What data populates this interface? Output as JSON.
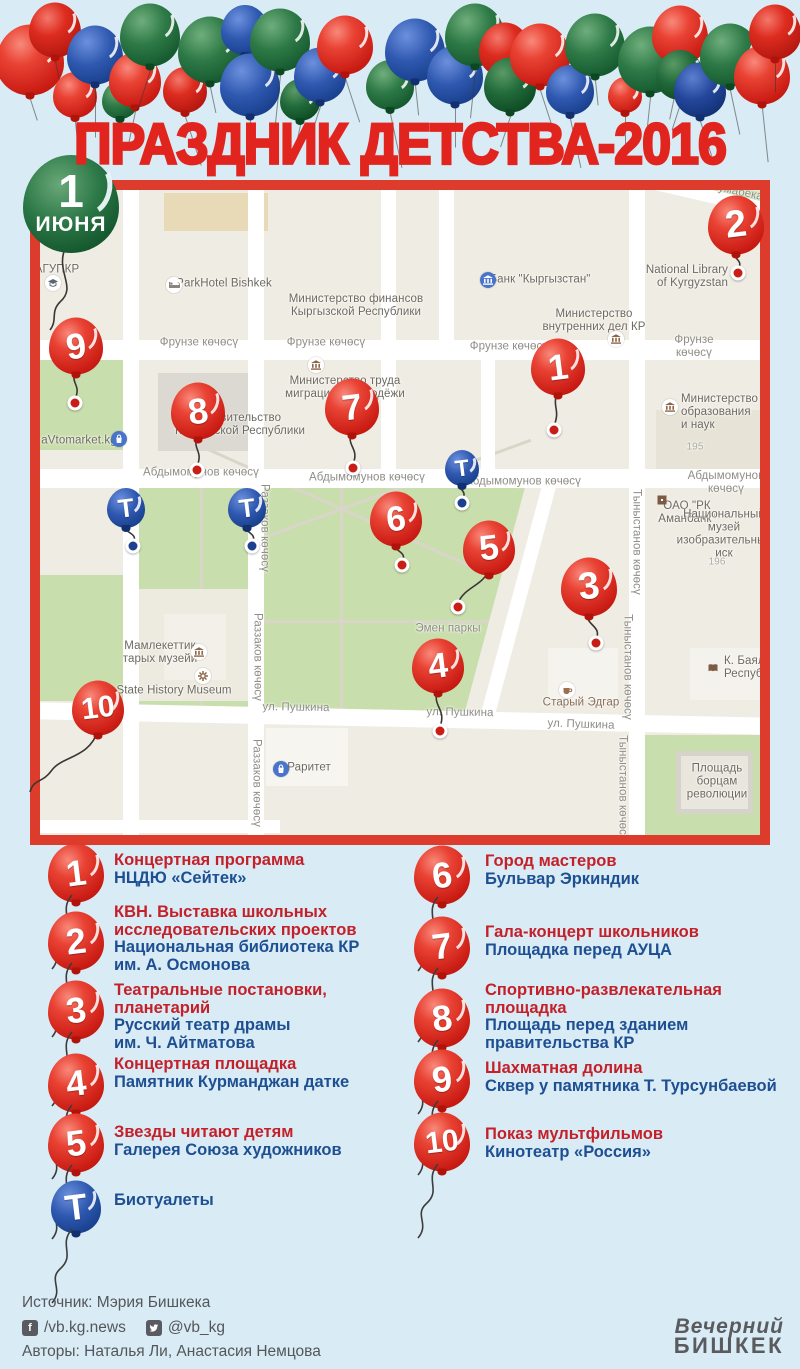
{
  "title": "ПРАЗДНИК ДЕТСТВА-2016",
  "date_badge": {
    "day": "1",
    "month": "ИЮНЯ"
  },
  "map": {
    "street_labels": [
      {
        "t": "Фрунзе көчөсү",
        "x": 159,
        "y": 153
      },
      {
        "t": "Фрунзе көчөсү",
        "x": 286,
        "y": 153
      },
      {
        "t": "Фрунзе көчөсү",
        "x": 469,
        "y": 157
      },
      {
        "t": "Фрунзе көчөсү",
        "x": 654,
        "y": 157
      },
      {
        "t": "Абдымомунов көчөсү",
        "x": 161,
        "y": 283
      },
      {
        "t": "Абдымомунов көчөсү",
        "x": 327,
        "y": 288
      },
      {
        "t": "Абдымомунов көчөсү",
        "x": 483,
        "y": 292
      },
      {
        "t": "Абдымомунов көчөсү",
        "x": 686,
        "y": 293
      },
      {
        "t": "Раззаков көчөсү",
        "x": 224,
        "y": 338,
        "rot": 90
      },
      {
        "t": "Раззаков көчөсү",
        "x": 217,
        "y": 467,
        "rot": 90
      },
      {
        "t": "Раззаков көчөсү",
        "x": 216,
        "y": 593,
        "rot": 90
      },
      {
        "t": "Тыныстанов көчөсү",
        "x": 596,
        "y": 352,
        "rot": 90
      },
      {
        "t": "Тыныстанов көчөсү",
        "x": 587,
        "y": 477,
        "rot": 90
      },
      {
        "t": "Тыныстанов көчөсү",
        "x": 582,
        "y": 598,
        "rot": 90
      },
      {
        "t": "ул. Пушкина",
        "x": 256,
        "y": 518,
        "rot": 1
      },
      {
        "t": "ул. Пушкина",
        "x": 420,
        "y": 523,
        "rot": 1
      },
      {
        "t": "ул. Пушкина",
        "x": 541,
        "y": 535,
        "rot": 2
      },
      {
        "t": "Жумабека к",
        "x": 694,
        "y": 8,
        "rot": 12
      },
      {
        "t": "Эмен паркы",
        "x": 408,
        "y": 439
      }
    ],
    "poi_labels": [
      {
        "t": "АГУПКР",
        "x": 17,
        "y": 80,
        "cls": "poi"
      },
      {
        "t": "ParkHotel Bishkek",
        "x": 184,
        "y": 94,
        "cls": "poi"
      },
      {
        "t": "Министерство финансов\nКыргызской Республики",
        "x": 316,
        "y": 116,
        "cls": "poi"
      },
      {
        "t": "Банк \"Кыргызстан\"",
        "x": 500,
        "y": 90,
        "cls": "poi"
      },
      {
        "t": "Министерство\nвнутренних дел КР",
        "x": 554,
        "y": 131,
        "cls": "poi"
      },
      {
        "t": "National Library\nof Kyrgyzstan",
        "left": 596,
        "top": 74,
        "w": 92,
        "align": "right",
        "cls": "poi"
      },
      {
        "t": "Правительство\nКыргызской Республики",
        "x": 200,
        "y": 235,
        "cls": "poi"
      },
      {
        "t": "Министерство труда\nмиграции и молодёжи",
        "x": 305,
        "y": 198,
        "cls": "poi"
      },
      {
        "t": "Министерство\nобразования и наук",
        "left": 641,
        "top": 203,
        "align": "left",
        "cls": "poi"
      },
      {
        "t": "ОАО \"РК Аманбанк\"",
        "x": 647,
        "y": 323,
        "cls": "poi"
      },
      {
        "t": "Национальный музей\nизобразительных иск",
        "x": 684,
        "y": 344,
        "cls": "poi"
      },
      {
        "t": "Мамлекеттик\nтарых музейи",
        "x": 120,
        "y": 463,
        "cls": "poi"
      },
      {
        "t": "State History Museum",
        "x": 134,
        "y": 501,
        "cls": "poi"
      },
      {
        "t": "Старый Эдгар",
        "x": 541,
        "y": 513,
        "cls": "brown"
      },
      {
        "t": "Раритет",
        "x": 269,
        "y": 578,
        "cls": "poi"
      },
      {
        "t": "aVtomarket.kg",
        "x": 39,
        "y": 251,
        "cls": "poi"
      },
      {
        "t": "К. Баялинова\nРеспубликанс",
        "left": 684,
        "top": 465,
        "align": "left",
        "cls": "poi"
      },
      {
        "t": "Площадь\nборцам\nреволюции",
        "x": 677,
        "y": 592,
        "cls": "poi"
      },
      {
        "t": "195",
        "x": 655,
        "y": 257,
        "cls": "num"
      },
      {
        "t": "196",
        "x": 677,
        "y": 372,
        "cls": "num"
      }
    ],
    "icons": [
      {
        "type": "cap",
        "x": 13,
        "y": 93
      },
      {
        "type": "bed",
        "x": 134,
        "y": 95
      },
      {
        "type": "bankblue",
        "x": 448,
        "y": 90
      },
      {
        "type": "bank",
        "x": 576,
        "y": 149
      },
      {
        "type": "bank",
        "x": 276,
        "y": 175
      },
      {
        "type": "bank",
        "x": 630,
        "y": 217
      },
      {
        "type": "museum",
        "x": 159,
        "y": 462
      },
      {
        "type": "gear",
        "x": 163,
        "y": 486
      },
      {
        "type": "coffee",
        "x": 527,
        "y": 500
      },
      {
        "type": "book",
        "x": 673,
        "y": 478
      },
      {
        "type": "bag",
        "x": 241,
        "y": 579
      },
      {
        "type": "bag",
        "x": 79,
        "y": 249
      },
      {
        "type": "sq",
        "x": 622,
        "y": 310
      }
    ],
    "markers": [
      {
        "label": "1",
        "x": 518,
        "y": 177,
        "r": 27,
        "color": "red",
        "dot": {
          "x": 514,
          "y": 240
        }
      },
      {
        "label": "2",
        "x": 696,
        "y": 35,
        "r": 28,
        "color": "red",
        "dot": {
          "x": 698,
          "y": 83
        }
      },
      {
        "label": "3",
        "x": 549,
        "y": 397,
        "r": 28,
        "color": "red",
        "dot": {
          "x": 556,
          "y": 453
        }
      },
      {
        "label": "4",
        "x": 398,
        "y": 476,
        "r": 26,
        "color": "red",
        "dot": {
          "x": 400,
          "y": 541
        }
      },
      {
        "label": "5",
        "x": 449,
        "y": 358,
        "r": 26,
        "color": "red",
        "dot": {
          "x": 418,
          "y": 417
        }
      },
      {
        "label": "6",
        "x": 356,
        "y": 329,
        "r": 26,
        "color": "red",
        "dot": {
          "x": 362,
          "y": 375
        }
      },
      {
        "label": "7",
        "x": 312,
        "y": 217,
        "r": 27,
        "color": "red",
        "dot": {
          "x": 313,
          "y": 278
        }
      },
      {
        "label": "8",
        "x": 158,
        "y": 221,
        "r": 27,
        "color": "red",
        "dot": {
          "x": 157,
          "y": 280
        }
      },
      {
        "label": "9",
        "x": 36,
        "y": 156,
        "r": 27,
        "color": "red",
        "dot": {
          "x": 35,
          "y": 213
        }
      },
      {
        "label": "10",
        "x": 58,
        "y": 518,
        "r": 26,
        "color": "red",
        "path": "M58 540 C50 568 22 566 12 580 C2 594 -6 588 -10 602"
      },
      {
        "label": "Т",
        "x": 86,
        "y": 318,
        "r": 19,
        "color": "blue",
        "dot": {
          "x": 93,
          "y": 356
        }
      },
      {
        "label": "Т",
        "x": 207,
        "y": 318,
        "r": 19,
        "color": "blue",
        "dot": {
          "x": 212,
          "y": 356
        }
      },
      {
        "label": "Т",
        "x": 422,
        "y": 278,
        "r": 17,
        "color": "blue",
        "dot": {
          "x": 422,
          "y": 313
        }
      }
    ],
    "badge_string": "M26 56 C14 82 38 96 20 112 C10 122 18 130 10 140"
  },
  "legend": {
    "left": [
      {
        "num": "1",
        "cy": 873,
        "ty": 852,
        "title": "Концертная программа",
        "sub": "НЦДЮ «Сейтек»"
      },
      {
        "num": "2",
        "cy": 941,
        "ty": 904,
        "title": "КВН. Выставка школьных\nисследовательских проектов",
        "sub": "Национальная библиотека КР\nим. А. Осмонова"
      },
      {
        "num": "3",
        "cy": 1010,
        "ty": 982,
        "title": "Театральные постановки,\nпланетарий",
        "sub": "Русский театр драмы\nим. Ч. Айтматова"
      },
      {
        "num": "4",
        "cy": 1083,
        "ty": 1056,
        "title": "Концертная площадка",
        "sub": "Памятник Курманджан датке"
      },
      {
        "num": "5",
        "cy": 1143,
        "ty": 1124,
        "title": "Звезды читают детям",
        "sub": "Галерея Союза художников"
      },
      {
        "num": "Т",
        "cy": 1207,
        "ty": 1192,
        "kind": "toilet",
        "title": "Биотуалеты",
        "sub": ""
      }
    ],
    "right": [
      {
        "num": "6",
        "cy": 875,
        "ty": 853,
        "title": "Город мастеров",
        "sub": "Бульвар Эркиндик"
      },
      {
        "num": "7",
        "cy": 946,
        "ty": 924,
        "title": "Гала-концерт школьников",
        "sub": "Площадка перед АУЦА"
      },
      {
        "num": "8",
        "cy": 1018,
        "ty": 982,
        "title": "Спортивно-развлекательная\nплощадка",
        "sub": "Площадь перед зданием\nправительства КР"
      },
      {
        "num": "9",
        "cy": 1079,
        "ty": 1060,
        "title": "Шахматная долина",
        "sub": "Сквер у памятника Т. Турсунбаевой"
      },
      {
        "num": "10",
        "cy": 1142,
        "ty": 1126,
        "title": "Показ мультфильмов",
        "sub": "Кинотеатр «Россия»"
      }
    ]
  },
  "footer": {
    "source": "Источник: Мэрия Бишкека",
    "facebook": "/vb.kg.news",
    "twitter": "@vb_kg",
    "authors": "Авторы: Наталья Ли, Анастасия Немцова"
  },
  "logo": {
    "line1": "Вечерний",
    "line2": "БИШКЕК"
  },
  "colors": {
    "background": "#d9ebf4",
    "accent_red": "#e2241e",
    "frame_red": "#dd3b2c",
    "legend_red": "#c4202a",
    "legend_blue": "#1e4f93",
    "balloon_red": "#d8251d",
    "balloon_green": "#1f6b33",
    "balloon_blue": "#1c3e90",
    "map_beige": "#efece3",
    "park_green": "#c9dead"
  }
}
